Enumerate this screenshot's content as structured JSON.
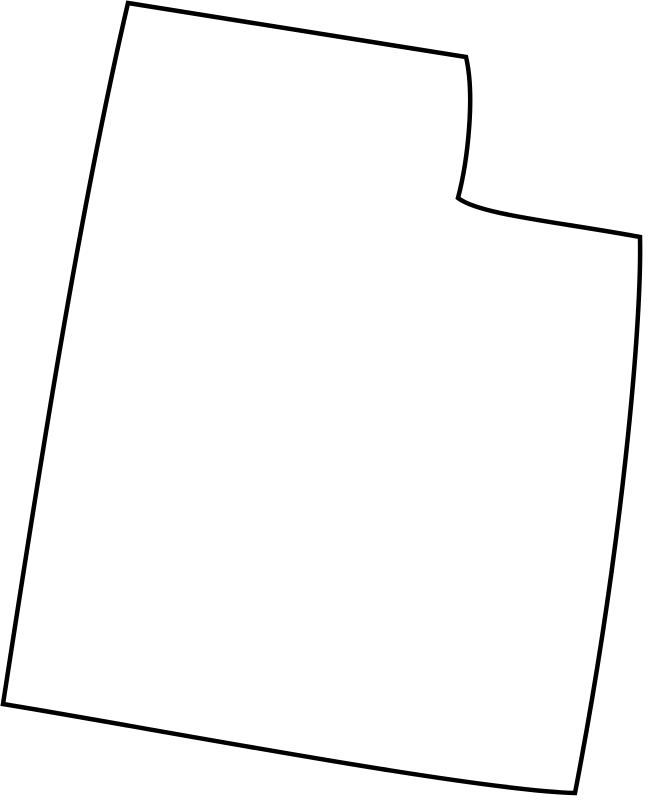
{
  "map": {
    "title": "blank-outline-map-of-utah",
    "region_name": "Utah",
    "background_color": "#ffffff",
    "stroke_color": "#000000",
    "stroke_width": 4.5,
    "viewbox": "0 0 649 800",
    "outline_path": "M 128,3 L 466,57 C 475,95 468,160 458,198 C 480,215 560,222 640,237 C 642,330 620,560 575,793 C 470,790 150,728 3,704 C 30,530 75,230 128,3 Z",
    "vertices": {
      "top_left_corner": [
        128,
        3
      ],
      "notch_top_corner": [
        466,
        57
      ],
      "notch_inner_corner": [
        458,
        198
      ],
      "right_edge_top_corner": [
        640,
        237
      ],
      "bottom_right_corner": [
        575,
        793
      ],
      "bottom_left_corner": [
        3,
        704
      ]
    }
  }
}
